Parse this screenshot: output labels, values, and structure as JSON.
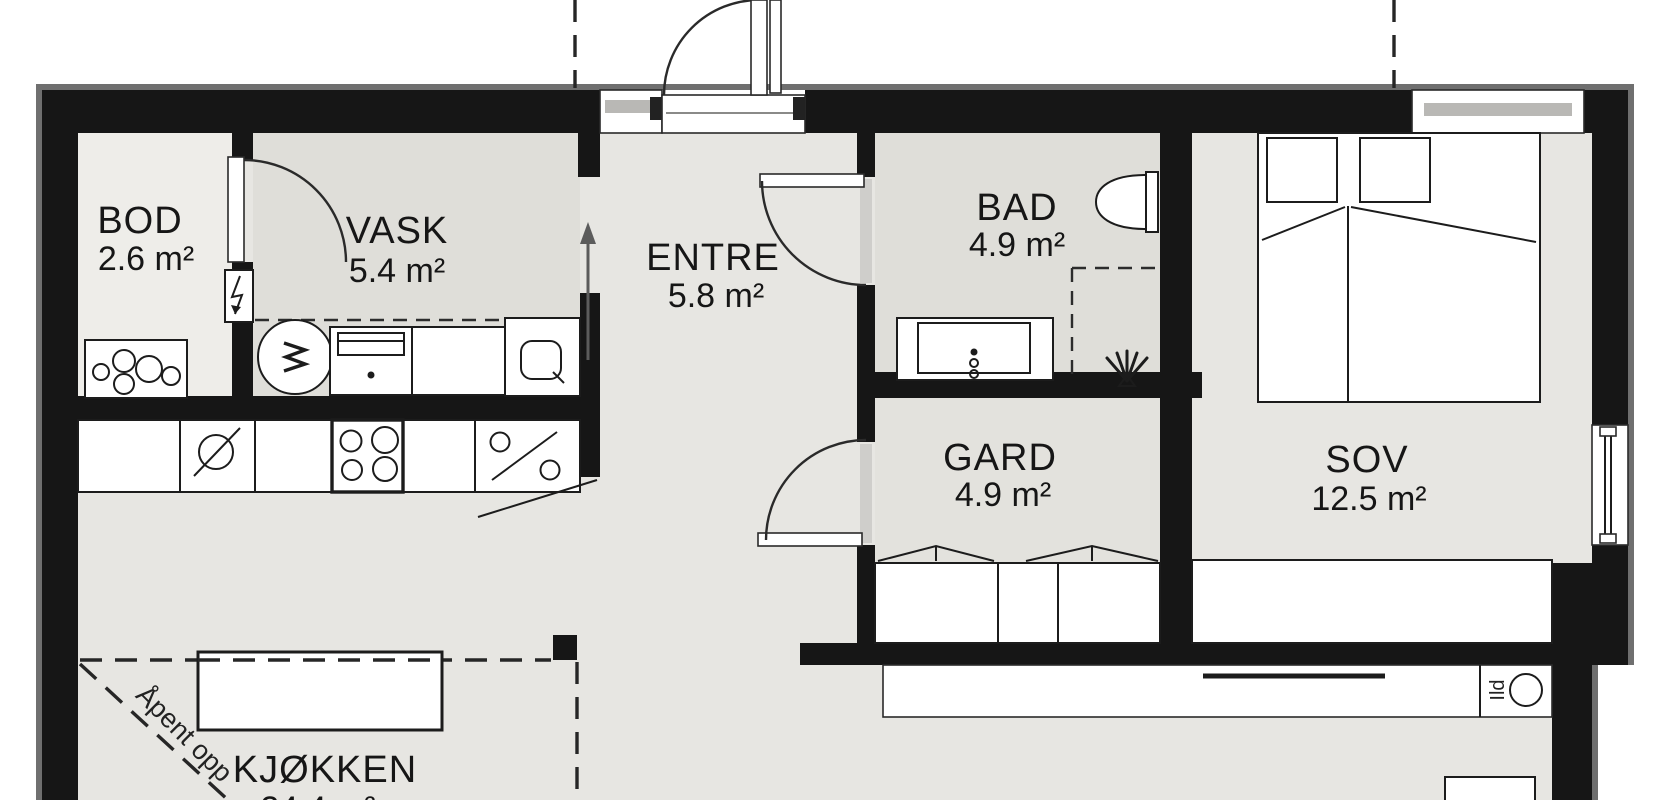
{
  "plan": {
    "title": "floor-plan",
    "rooms": [
      {
        "id": "bod",
        "name": "BOD",
        "area": "2.6 m²"
      },
      {
        "id": "vask",
        "name": "VASK",
        "area": "5.4 m²"
      },
      {
        "id": "entre",
        "name": "ENTRE",
        "area": "5.8 m²"
      },
      {
        "id": "bad",
        "name": "BAD",
        "area": "4.9 m²"
      },
      {
        "id": "gard",
        "name": "GARD",
        "area": "4.9 m²"
      },
      {
        "id": "sov",
        "name": "SOV",
        "area": "12.5 m²"
      },
      {
        "id": "kjokken",
        "name": "KJØKKEN",
        "area": "24.4 m²"
      }
    ],
    "annotations": {
      "open_above": "Åpent opp",
      "fireplace": "Ild"
    },
    "colors": {
      "wall": "#161616",
      "wall_edge": "#6f6f6f",
      "floor": "#e7e6e2",
      "floor_light": "#eeede9",
      "floor_dark": "#dfded9",
      "furniture": "#ffffff"
    },
    "icons": [
      "washing-machine-icon",
      "laundry-sink-icon",
      "tall-cabinet-icon",
      "dishwasher-icon",
      "kitchen-sink-icon",
      "cooktop-icon",
      "water-heater-icon",
      "fuse-box-icon",
      "toilet-icon",
      "shower-icon",
      "vanity-sink-icon",
      "double-bed-icon",
      "wardrobe-icon",
      "fireplace-icon",
      "direction-arrow-icon"
    ]
  }
}
